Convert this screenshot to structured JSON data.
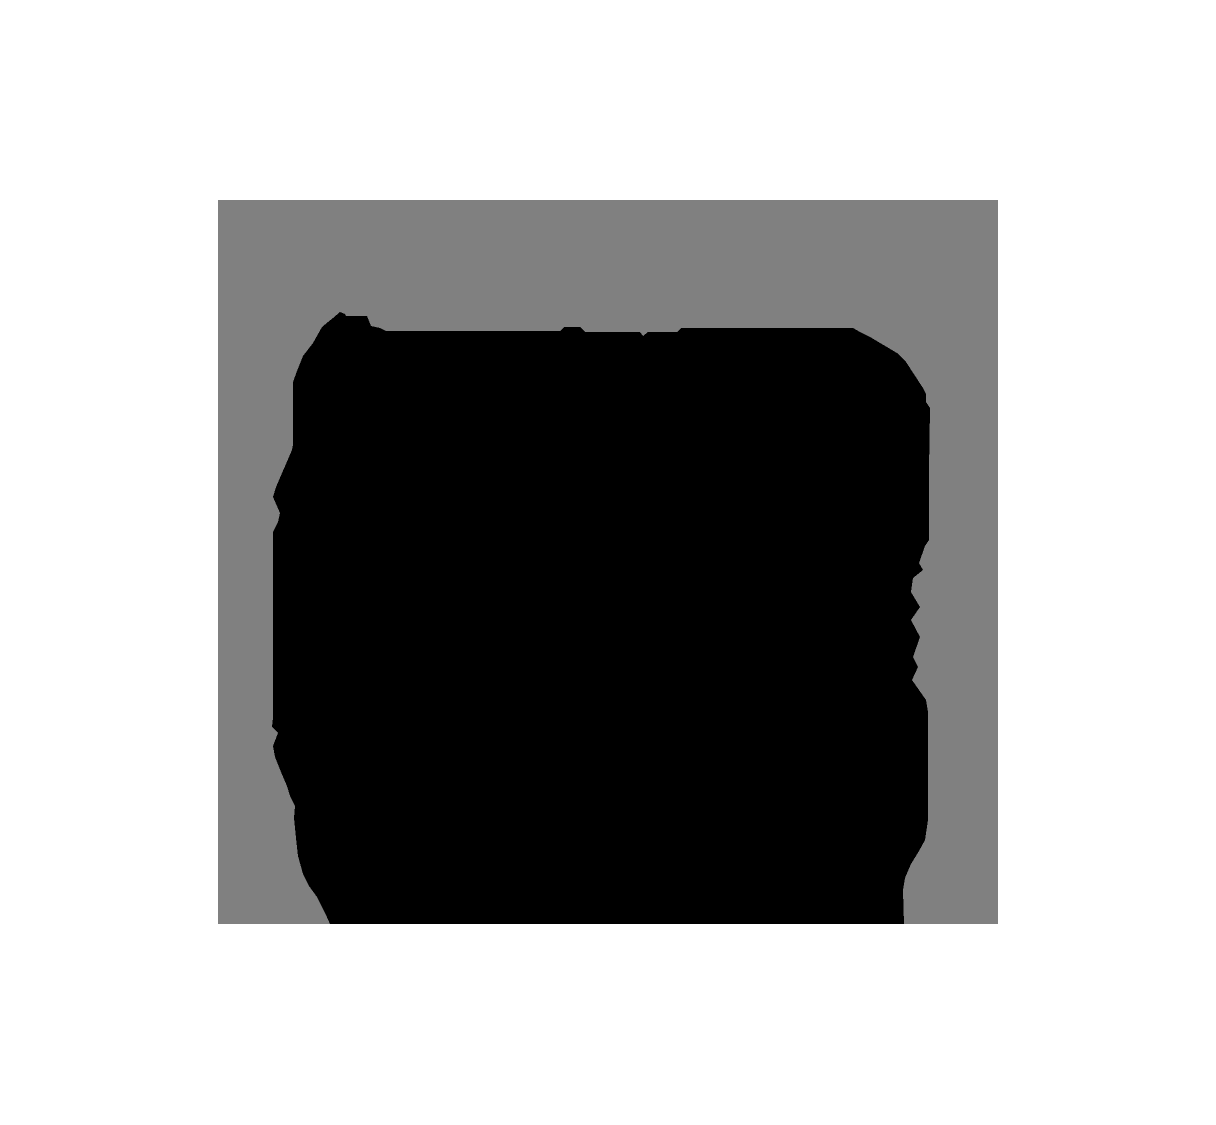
{
  "image": {
    "type": "segmentation-trimap-mask",
    "width": 1216,
    "height": 1125,
    "description": "Ternary mask: white background, gray unknown band, black foreground blob"
  },
  "colors": {
    "background": "#ffffff",
    "unknown": "#808080",
    "foreground": "#000000"
  },
  "mask": {
    "background_points": "0,0 1216,0 1216,1125 0,1125",
    "unknown_points": "218,200 998,200 998,924 218,924",
    "foreground_points": "333,318 340,312 345,314 346,316 367,316 371,326 380,328 386,331 560,331 564,327 580,327 585,332 640,332 643,336 648,332 677,332 681,328 853,328 860,332 870,337 897,353 906,362 923,388 926,394 926,402 930,408 929,470 929,540 925,546 919,563 923,570 913,578 911,592 920,607 911,620 920,637 913,657 918,667 912,680 926,700 928,712 928,820 925,840 919,851 911,864 905,878 903,890 904,924 330,924 326,915 317,897 309,886 303,874 298,856 296,838 294,818 295,806 290,796 287,786 281,772 275,757 273,746 278,733 272,727 273,718 273,532 278,522 280,513 273,497 276,487 292,450 293,445 293,382 297,371 303,356 313,343 322,327 328,322"
  }
}
